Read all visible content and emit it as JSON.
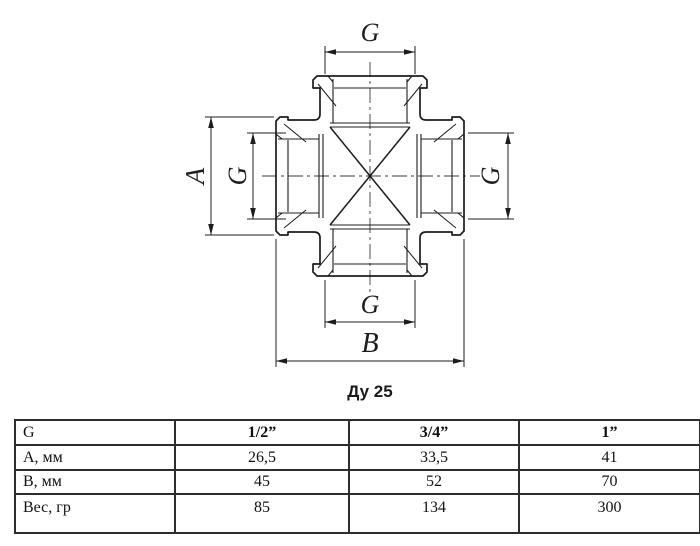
{
  "drawing": {
    "caption": "Ду 25",
    "labels": {
      "top": "G",
      "left_outer": "A",
      "left_inner": "G",
      "right": "G",
      "bottom_inner": "G",
      "bottom_outer": "B"
    }
  },
  "table": {
    "rows": [
      {
        "label": "G",
        "values": [
          "1/2”",
          "3/4”",
          "1”"
        ]
      },
      {
        "label": "А, мм",
        "values": [
          "26,5",
          "33,5",
          "41"
        ]
      },
      {
        "label": "В, мм",
        "values": [
          "45",
          "52",
          "70"
        ]
      },
      {
        "label": "Вес, гр",
        "values": [
          "85",
          "134",
          "300"
        ]
      }
    ]
  },
  "colors": {
    "line": "#1c1c1c",
    "background": "#ffffff"
  }
}
